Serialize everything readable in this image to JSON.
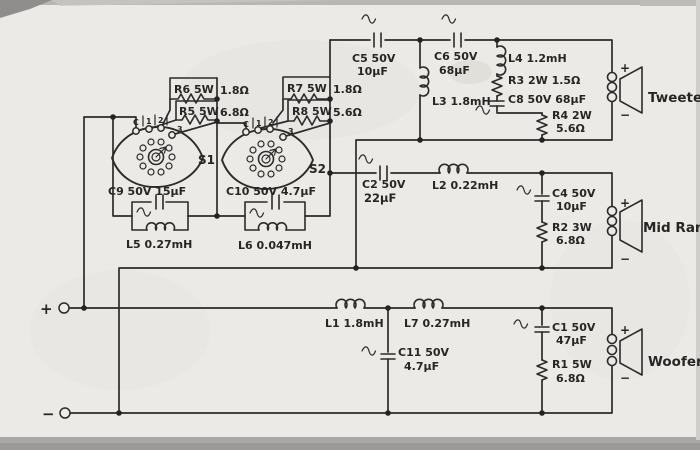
{
  "schematic_type": "3-way speaker crossover circuit",
  "input": {
    "plus": "+",
    "minus": "−"
  },
  "speakers": {
    "tweeter": {
      "name": "Tweeter",
      "plus": "+",
      "minus": "−"
    },
    "midrange": {
      "name": "Mid Range",
      "plus": "+",
      "minus": "−"
    },
    "woofer": {
      "name": "Woofer",
      "plus": "+",
      "minus": "−"
    }
  },
  "switches": {
    "s1": {
      "name": "S1",
      "c": "C",
      "p1": "1",
      "p2": "2",
      "p3": "3"
    },
    "s2": {
      "name": "S2",
      "c": "C",
      "p1": "1",
      "p2": "2",
      "p3": "3"
    }
  },
  "components": {
    "c5": {
      "line1": "C5 50V",
      "line2": "10µF"
    },
    "c6": {
      "line1": "C6 50V",
      "line2": "68µF"
    },
    "l3": {
      "label": "L3 1.8mH"
    },
    "l4": {
      "label": "L4 1.2mH"
    },
    "r3": {
      "label": "R3 2W 1.5Ω"
    },
    "c8": {
      "label": "C8 50V 68µF"
    },
    "r4": {
      "line1": "R4 2W",
      "line2": "5.6Ω"
    },
    "r6": {
      "name": "R6 5W",
      "value": "1.8Ω"
    },
    "r5": {
      "name": "R5 5W",
      "value": "6.8Ω"
    },
    "r7": {
      "name": "R7 5W",
      "value": "1.8Ω"
    },
    "r8": {
      "name": "R8 5W",
      "value": "5.6Ω"
    },
    "c9": {
      "label": "C9 50V 15µF"
    },
    "l5": {
      "label": "L5 0.27mH"
    },
    "c10": {
      "label": "C10 50V 4.7µF"
    },
    "l6": {
      "label": "L6 0.047mH"
    },
    "c2": {
      "line1": "C2 50V",
      "line2": "22µF"
    },
    "l2": {
      "label": "L2 0.22mH"
    },
    "c4": {
      "line1": "C4 50V",
      "line2": "10µF"
    },
    "r2": {
      "line1": "R2 3W",
      "line2": "6.8Ω"
    },
    "l1": {
      "label": "L1 1.8mH"
    },
    "l7": {
      "label": "L7 0.27mH"
    },
    "c11": {
      "line1": "C11 50V",
      "line2": "4.7µF"
    },
    "c1": {
      "line1": "C1 50V",
      "line2": "47µF"
    },
    "r1": {
      "line1": "R1 5W",
      "line2": "6.8Ω"
    }
  }
}
